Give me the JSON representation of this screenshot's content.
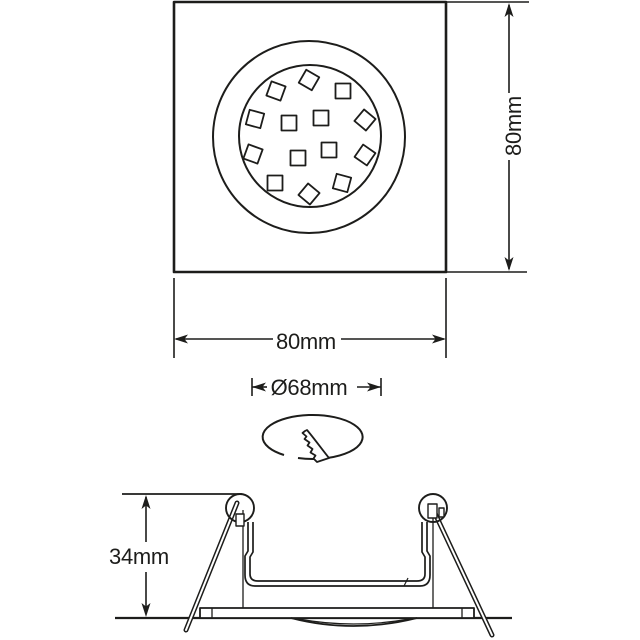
{
  "colors": {
    "line": "#1d1d1b",
    "background": "#ffffff"
  },
  "top_view": {
    "height_label": "80mm",
    "width_label": "80mm"
  },
  "cutout": {
    "diameter_label": "Ø68mm"
  },
  "side_view": {
    "height_label": "34mm"
  }
}
